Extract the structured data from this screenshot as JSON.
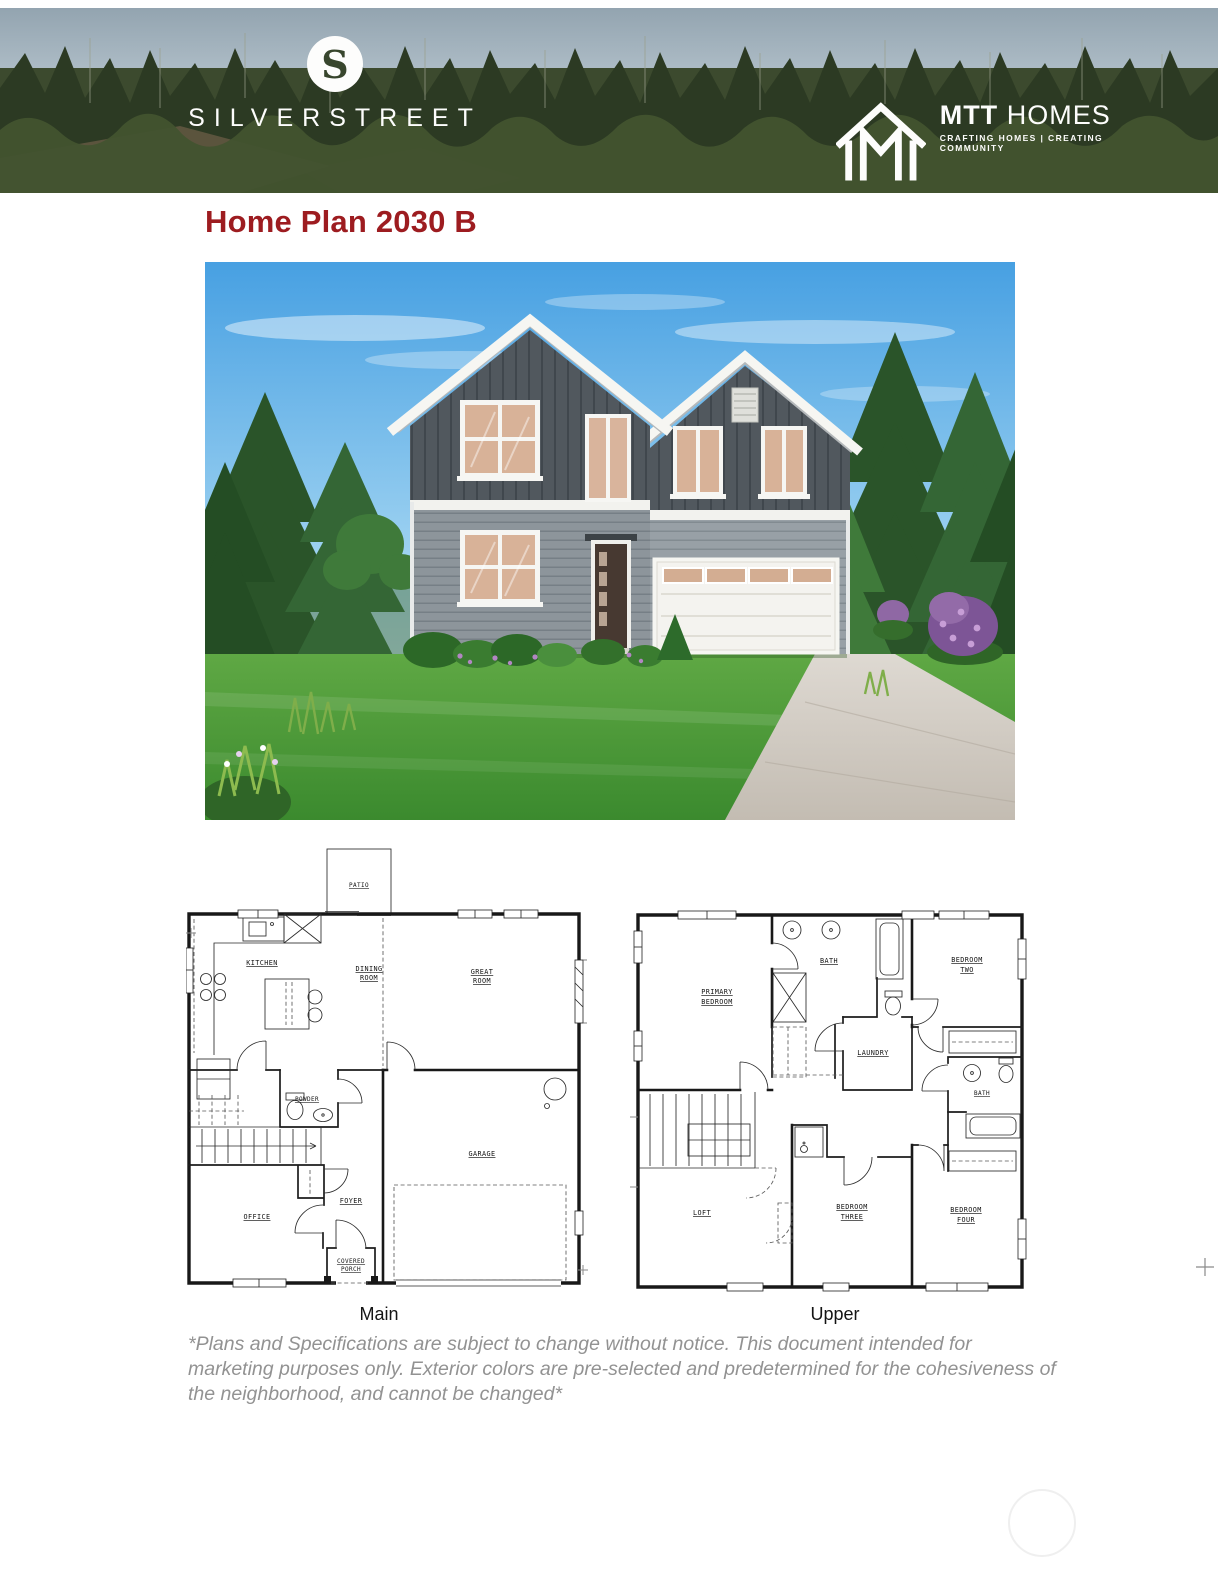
{
  "colors": {
    "title_red": "#9d1c20",
    "disclaimer_gray": "#929292",
    "plan_ink": "#181818",
    "banner_forest_green": "#35432b",
    "house_upper_siding": "#51585e",
    "house_lower_siding": "#8d959b",
    "house_trim_white": "#f4f4f0"
  },
  "banner": {
    "silverstreet": {
      "icon_letter": "S",
      "wordmark": "SILVERSTREET"
    },
    "mtt": {
      "brand_bold": "MTT",
      "brand_light": "HOMES",
      "tagline": "CRAFTING HOMES  |  CREATING COMMUNITY"
    }
  },
  "title": "Home Plan 2030 B",
  "plans": {
    "main": {
      "caption": "Main",
      "rooms": {
        "patio": "PATIO",
        "kitchen": "KITCHEN",
        "dining": [
          "DINING",
          "ROOM"
        ],
        "great": [
          "GREAT",
          "ROOM"
        ],
        "powder": "POWDER",
        "office": "OFFICE",
        "foyer": "FOYER",
        "porch": [
          "COVERED",
          "PORCH"
        ],
        "garage": "GARAGE"
      }
    },
    "upper": {
      "caption": "Upper",
      "rooms": {
        "primary": [
          "PRIMARY",
          "BEDROOM"
        ],
        "bath": "BATH",
        "bedroom2": [
          "BEDROOM",
          "TWO"
        ],
        "laundry": "LAUNDRY",
        "bath2": "BATH",
        "loft": "LOFT",
        "bedroom3": [
          "BEDROOM",
          "THREE"
        ],
        "bedroom4": [
          "BEDROOM",
          "FOUR"
        ]
      }
    }
  },
  "disclaimer": {
    "lines": [
      "*Plans and Specifications are subject to change without notice. This document intended for",
      "marketing purposes only. Exterior colors are pre-selected and predetermined for the cohesiveness of",
      "the neighborhood, and cannot be changed*"
    ]
  }
}
